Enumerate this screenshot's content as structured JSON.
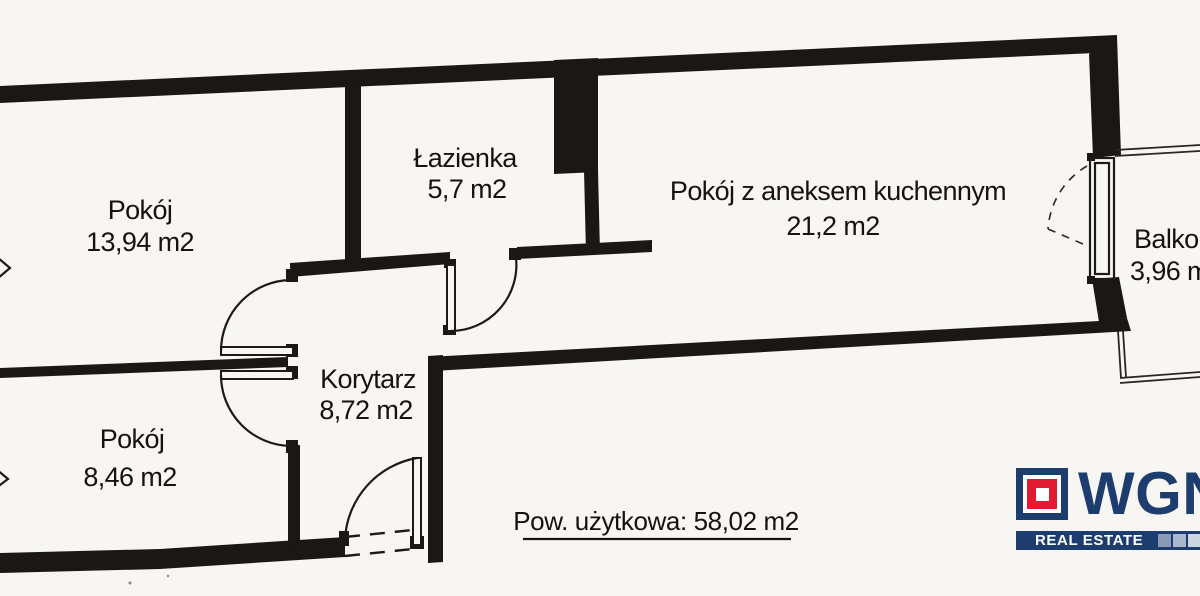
{
  "colors": {
    "paper": "#f7f6f3",
    "ink": "#1b1715",
    "logo_navy": "#1d3d6f",
    "logo_red": "#e11931",
    "logo_bar_squares": [
      "#8a9ab5",
      "#abb8cb",
      "#ced6e2"
    ]
  },
  "rooms": {
    "pokoj1": {
      "name": "Pokój",
      "area": "13,94 m2"
    },
    "lazienka": {
      "name": "Łazienka",
      "area": "5,7 m2"
    },
    "livingroom": {
      "name": "Pokój z aneksem kuchennym",
      "area": "21,2 m2"
    },
    "korytarz": {
      "name": "Korytarz",
      "area": "8,72 m2"
    },
    "pokoj2": {
      "name": "Pokój",
      "area": "8,46 m2"
    },
    "balkon": {
      "name": "Balkon",
      "area": "3,96 m2"
    }
  },
  "summary": {
    "usable_area_label": "Pow. użytkowa: 58,02 m2"
  },
  "logo": {
    "brand": "WGN",
    "tagline": "REAL ESTATE"
  }
}
